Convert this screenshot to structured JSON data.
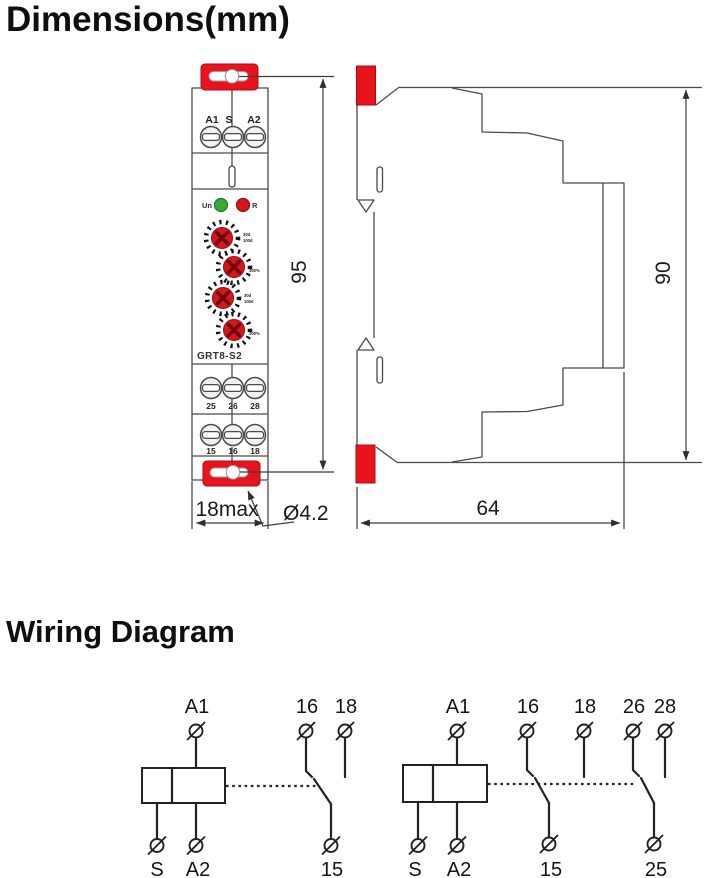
{
  "title": "Dimensions(mm)",
  "wiring_title": "Wiring Diagram",
  "colors": {
    "accent_red": "#e8131d",
    "led_green": "#3aaa35",
    "led_red": "#d6161d",
    "line_gray": "#4a4a4a",
    "text": "#111111"
  },
  "front_view": {
    "model": "GRT8-S2",
    "top_terminals": [
      "A1",
      "S",
      "A2"
    ],
    "led_labels": {
      "power": "Un",
      "relay": "R"
    },
    "dial_labels": {
      "d1a": "30d",
      "d1b": "100d",
      "d2": "100%",
      "d3a": "30d",
      "d3b": "100d",
      "d4": "100%"
    },
    "mid_terminals": [
      "25",
      "26",
      "28"
    ],
    "bottom_terminals": [
      "15",
      "16",
      "18"
    ]
  },
  "dimensions": {
    "front_height": "95",
    "front_width": "18max",
    "hole_diameter": "Ø4.2",
    "side_height": "90",
    "side_depth": "64"
  },
  "wiring": {
    "left": {
      "coil_top": "A1",
      "coil_bottom_left": "S",
      "coil_bottom_right": "A2",
      "contact_no": "16",
      "contact_nc": "18",
      "contact_common": "15"
    },
    "right": {
      "coil_top": "A1",
      "coil_bottom_left": "S",
      "coil_bottom_right": "A2",
      "pole1_no": "16",
      "pole1_nc": "18",
      "pole1_common": "15",
      "pole2_no": "26",
      "pole2_nc": "28",
      "pole2_common": "25"
    }
  }
}
